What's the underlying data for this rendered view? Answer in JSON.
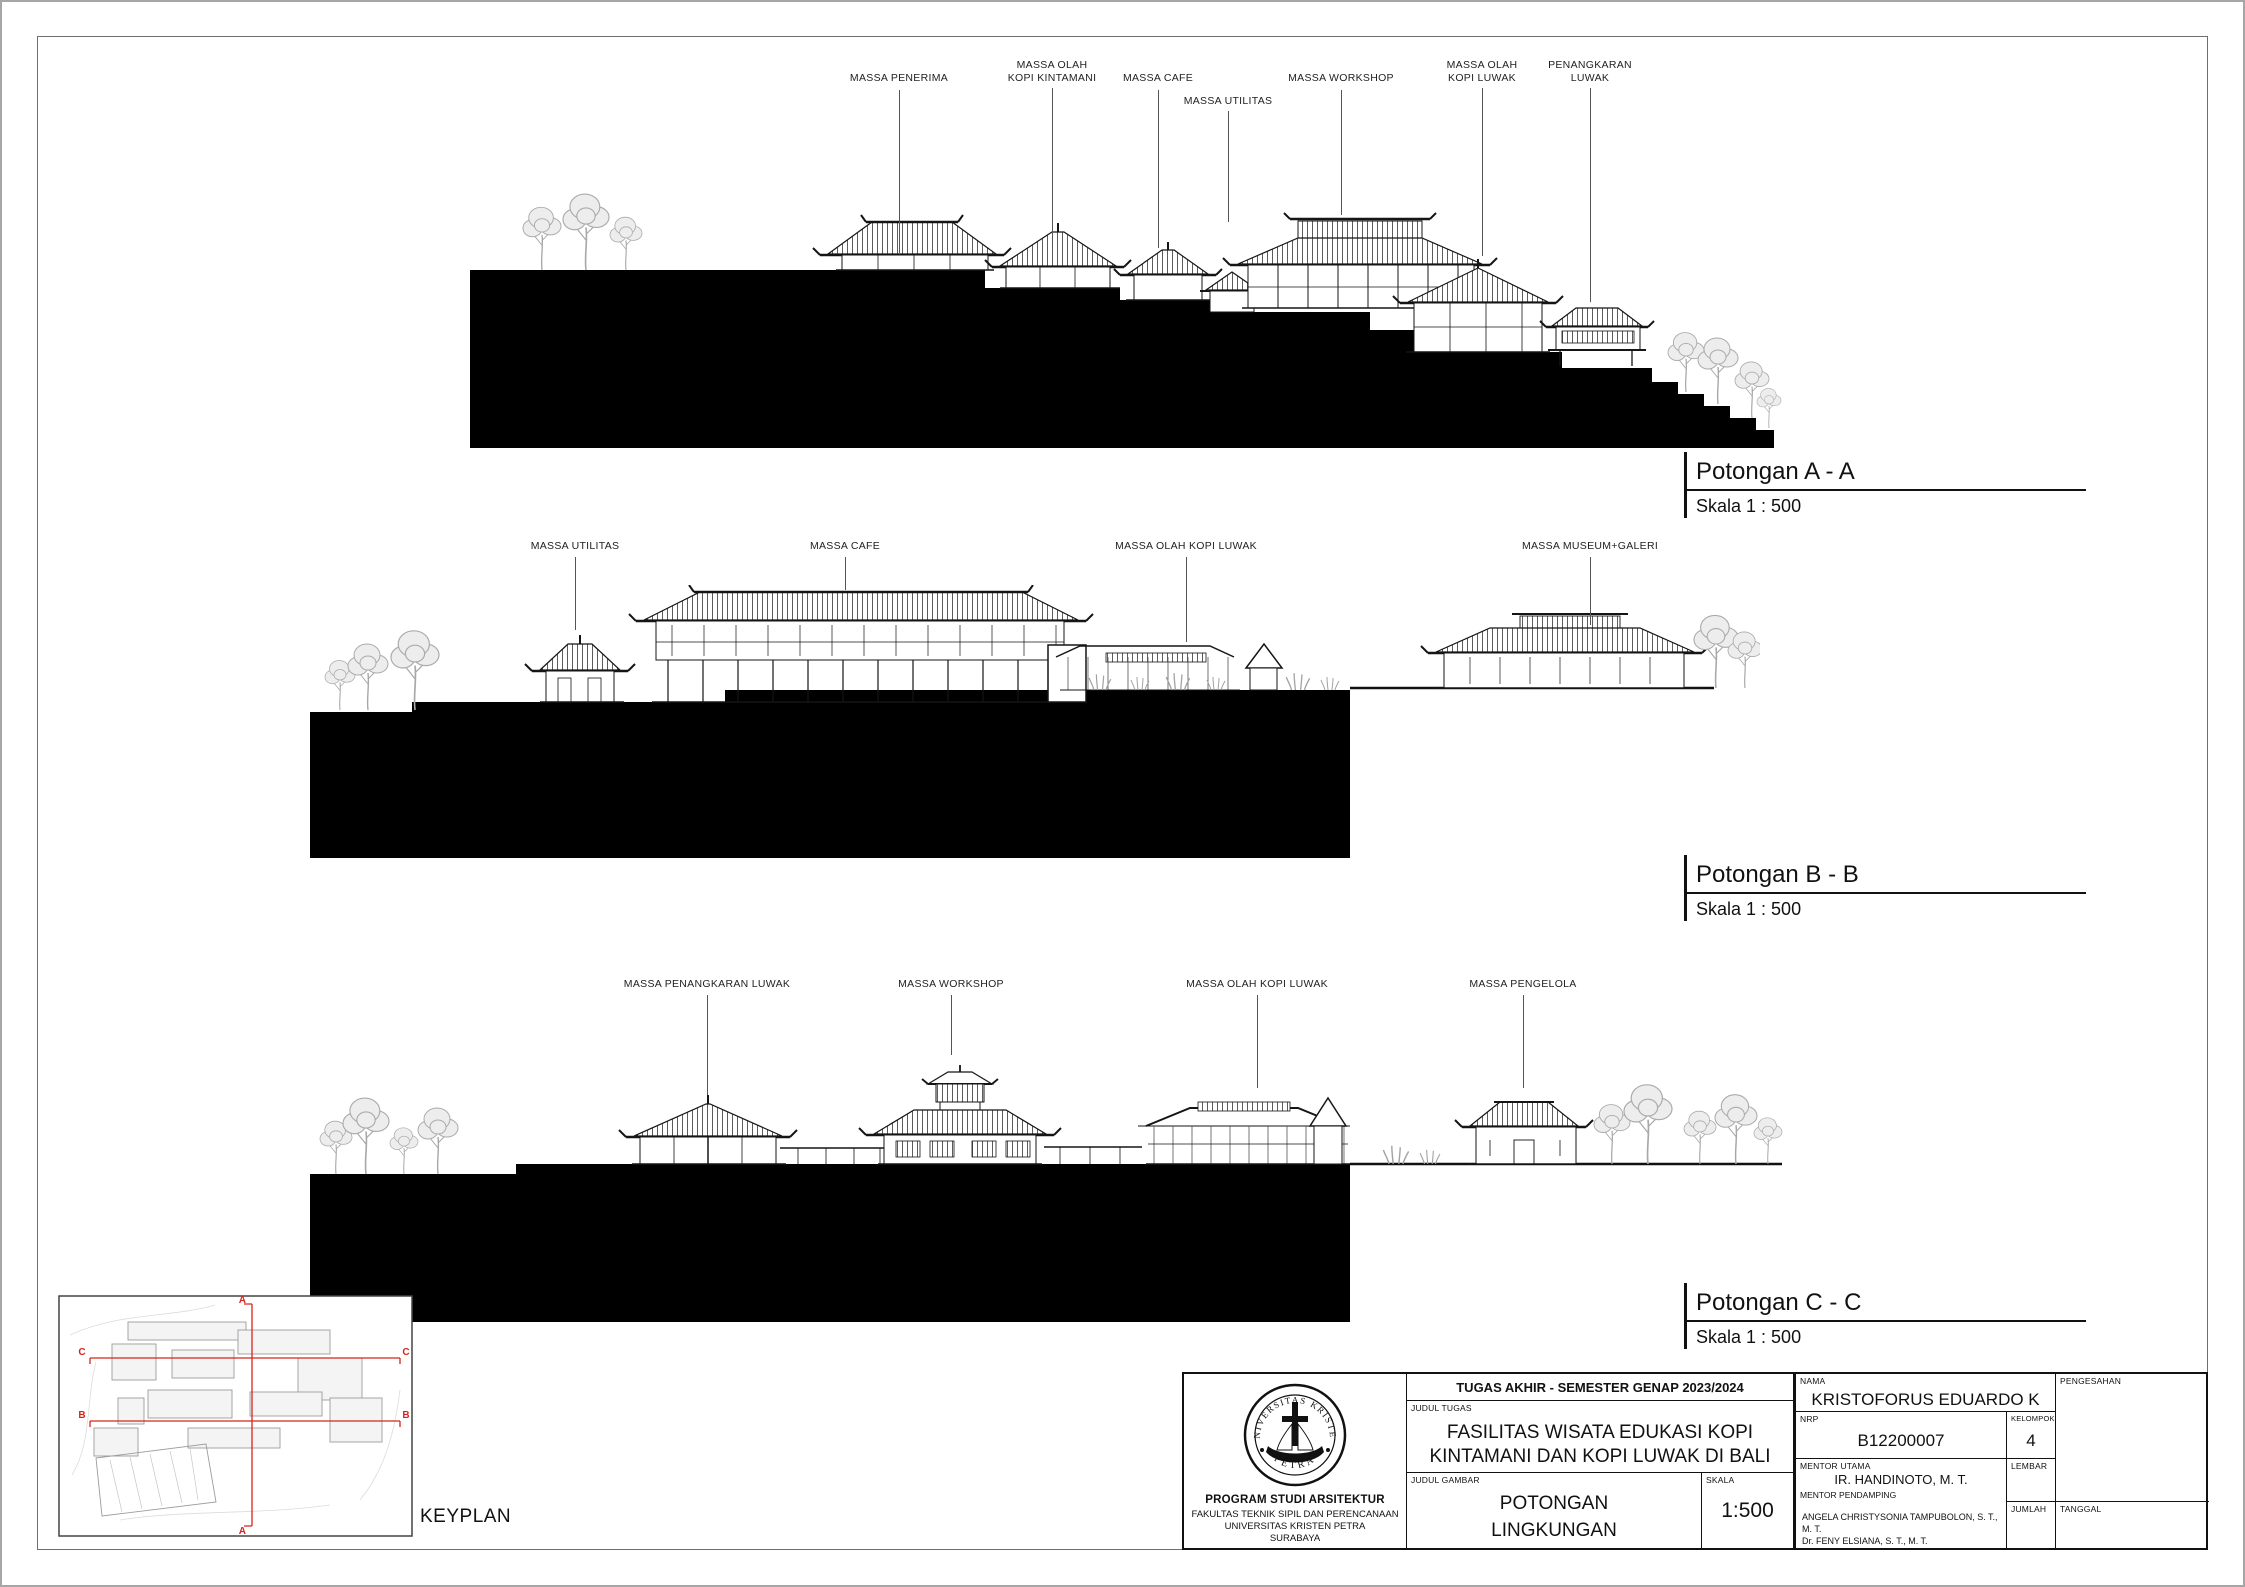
{
  "colors": {
    "ink": "#111111",
    "section_marker_red": "#d6251d",
    "tree_gray": "#a8a8a8"
  },
  "sections": {
    "a": {
      "title": "Potongan A - A",
      "scale_label": "Skala 1 : 500",
      "labels": [
        "MASSA PENERIMA",
        "MASSA OLAH\nKOPI KINTAMANI",
        "MASSA CAFE",
        "MASSA UTILITAS",
        "MASSA WORKSHOP",
        "MASSA OLAH\nKOPI LUWAK",
        "PENANGKARAN\nLUWAK"
      ]
    },
    "b": {
      "title": "Potongan B - B",
      "scale_label": "Skala 1 : 500",
      "labels": [
        "MASSA UTILITAS",
        "MASSA CAFE",
        "MASSA OLAH KOPI LUWAK",
        "MASSA MUSEUM+GALERI"
      ]
    },
    "c": {
      "title": "Potongan C - C",
      "scale_label": "Skala 1 : 500",
      "labels": [
        "MASSA PENANGKARAN LUWAK",
        "MASSA WORKSHOP",
        "MASSA OLAH KOPI LUWAK",
        "MASSA PENGELOLA"
      ]
    }
  },
  "keyplan": {
    "label": "KEYPLAN",
    "marker_a": "A",
    "marker_b": "B",
    "marker_c": "C"
  },
  "title_block": {
    "header": "TUGAS AKHIR - SEMESTER GENAP 2023/2024",
    "judul_tugas_label": "JUDUL TUGAS",
    "judul_tugas": "FASILITAS WISATA EDUKASI KOPI\nKINTAMANI DAN KOPI LUWAK DI BALI",
    "judul_gambar_label": "JUDUL GAMBAR",
    "judul_gambar": "POTONGAN\nLINGKUNGAN",
    "skala_label": "SKALA",
    "skala_value": "1:500",
    "nama_label": "NAMA",
    "nama_value": "KRISTOFORUS EDUARDO K",
    "nrp_label": "NRP",
    "nrp_value": "B12200007",
    "kelompok_label": "KELOMPOK",
    "kelompok_value": "4",
    "mentor_utama_label": "MENTOR UTAMA",
    "mentor_utama_value": "IR. HANDINOTO, M. T.",
    "mentor_pendamping_label": "MENTOR PENDAMPING",
    "mentor_pendamping_value": "ANGELA CHRISTYSONIA TAMPUBOLON, S. T., M. T.\nDr. FENY ELSIANA, S. T., M. T.",
    "lembar_label": "LEMBAR",
    "jumlah_label": "JUMLAH",
    "pengesahan_label": "PENGESAHAN",
    "tanggal_label": "TANGGAL",
    "institution": {
      "seal_top": "UNIVERSITAS KRISTEN",
      "seal_bottom": "PETRA",
      "program": "PROGRAM STUDI ARSITEKTUR",
      "faculty": "FAKULTAS TEKNIK SIPIL DAN PERENCANAAN",
      "university": "UNIVERSITAS KRISTEN PETRA",
      "city": "SURABAYA"
    }
  }
}
